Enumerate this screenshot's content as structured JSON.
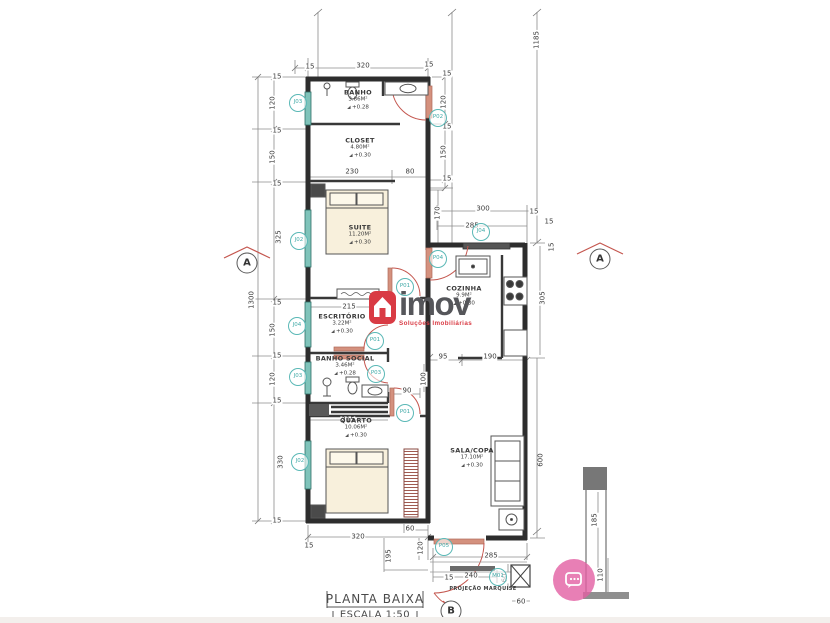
{
  "watermark": {
    "brand": "imov",
    "subtitle": "Soluções Imobiliárias",
    "icon": "house-icon",
    "icon_color": "#d93b44",
    "brand_color": "#55565a"
  },
  "title_block": {
    "line1": "PLANTA BAIXA",
    "line2": "ESCALA 1:50"
  },
  "colors": {
    "tag_teal": "#45b0ae",
    "door_red": "#c4564e",
    "window_teal": "#7fc3ba",
    "chat_pink": "#e25fa3",
    "bed_fill": "#f8f0dc"
  },
  "rooms": [
    {
      "name": "BANHO",
      "area": "3.86M²",
      "level": "+0.28",
      "x": 358,
      "y": 100
    },
    {
      "name": "CLOSET",
      "area": "4.80M²",
      "level": "+0.30",
      "x": 360,
      "y": 148
    },
    {
      "name": "SUITE",
      "area": "11.20M²",
      "level": "+0.30",
      "x": 360,
      "y": 235
    },
    {
      "name": "ESCRITÓRIO",
      "area": "3.22M²",
      "level": "+0.30",
      "x": 342,
      "y": 324
    },
    {
      "name": "BANHO SOCIAL",
      "area": "3.46M²",
      "level": "+0.28",
      "x": 345,
      "y": 366
    },
    {
      "name": "QUARTO",
      "area": "10.06M²",
      "level": "+0.30",
      "x": 356,
      "y": 428
    },
    {
      "name": "COZINHA",
      "area": "9.9M²",
      "level": "+0.30",
      "x": 464,
      "y": 296
    },
    {
      "name": "SALA/COPA",
      "area": "17.10M²",
      "level": "+0.30",
      "x": 472,
      "y": 458
    }
  ],
  "tags": [
    {
      "t": "J03",
      "x": 298,
      "y": 103
    },
    {
      "t": "P02",
      "x": 438,
      "y": 118
    },
    {
      "t": "J02",
      "x": 299,
      "y": 241
    },
    {
      "t": "P04",
      "x": 438,
      "y": 259
    },
    {
      "t": "P01",
      "x": 405,
      "y": 287
    },
    {
      "t": "J04",
      "x": 481,
      "y": 232
    },
    {
      "t": "J04",
      "x": 297,
      "y": 326
    },
    {
      "t": "P01",
      "x": 375,
      "y": 341
    },
    {
      "t": "P03",
      "x": 376,
      "y": 374
    },
    {
      "t": "J03",
      "x": 298,
      "y": 377
    },
    {
      "t": "P01",
      "x": 405,
      "y": 413
    },
    {
      "t": "J02",
      "x": 300,
      "y": 462
    },
    {
      "t": "P05",
      "x": 444,
      "y": 547
    },
    {
      "t": "M01",
      "x": 498,
      "y": 577
    }
  ],
  "dim_labels": [
    {
      "t": "320",
      "x": 363,
      "y": 66
    },
    {
      "t": "15",
      "x": 310,
      "y": 67
    },
    {
      "t": "15",
      "x": 429,
      "y": 65
    },
    {
      "t": "1185",
      "x": 537,
      "y": 40,
      "r": 1
    },
    {
      "t": "15",
      "x": 277,
      "y": 77
    },
    {
      "t": "120",
      "x": 273,
      "y": 103,
      "r": 1
    },
    {
      "t": "15",
      "x": 277,
      "y": 131
    },
    {
      "t": "150",
      "x": 273,
      "y": 157,
      "r": 1
    },
    {
      "t": "15",
      "x": 277,
      "y": 184
    },
    {
      "t": "325",
      "x": 279,
      "y": 237,
      "r": 1
    },
    {
      "t": "1300",
      "x": 252,
      "y": 300,
      "r": 1
    },
    {
      "t": "15",
      "x": 277,
      "y": 303
    },
    {
      "t": "150",
      "x": 273,
      "y": 330,
      "r": 1
    },
    {
      "t": "15",
      "x": 277,
      "y": 356
    },
    {
      "t": "120",
      "x": 273,
      "y": 379,
      "r": 1
    },
    {
      "t": "15",
      "x": 277,
      "y": 401
    },
    {
      "t": "330",
      "x": 281,
      "y": 462,
      "r": 1
    },
    {
      "t": "15",
      "x": 277,
      "y": 521
    },
    {
      "t": "15",
      "x": 447,
      "y": 74
    },
    {
      "t": "120",
      "x": 444,
      "y": 102,
      "r": 1
    },
    {
      "t": "15",
      "x": 447,
      "y": 127
    },
    {
      "t": "150",
      "x": 444,
      "y": 152,
      "r": 1
    },
    {
      "t": "15",
      "x": 447,
      "y": 179
    },
    {
      "t": "170",
      "x": 438,
      "y": 213,
      "r": 1
    },
    {
      "t": "230",
      "x": 352,
      "y": 172
    },
    {
      "t": "80",
      "x": 410,
      "y": 172
    },
    {
      "t": "300",
      "x": 483,
      "y": 209
    },
    {
      "t": "15",
      "x": 534,
      "y": 212
    },
    {
      "t": "285",
      "x": 472,
      "y": 226
    },
    {
      "t": "15",
      "x": 549,
      "y": 222
    },
    {
      "t": "15",
      "x": 552,
      "y": 247,
      "r": 1
    },
    {
      "t": "305",
      "x": 543,
      "y": 298,
      "r": 1
    },
    {
      "t": "215",
      "x": 349,
      "y": 307
    },
    {
      "t": "95",
      "x": 443,
      "y": 357
    },
    {
      "t": "190",
      "x": 490,
      "y": 357
    },
    {
      "t": "100",
      "x": 424,
      "y": 379,
      "r": 1
    },
    {
      "t": "90",
      "x": 407,
      "y": 391
    },
    {
      "t": "215",
      "x": 348,
      "y": 420
    },
    {
      "t": "60",
      "x": 410,
      "y": 529
    },
    {
      "t": "320",
      "x": 358,
      "y": 537
    },
    {
      "t": "15",
      "x": 309,
      "y": 546
    },
    {
      "t": "120",
      "x": 421,
      "y": 548,
      "r": 1
    },
    {
      "t": "195",
      "x": 389,
      "y": 556,
      "r": 1
    },
    {
      "t": "285",
      "x": 491,
      "y": 556
    },
    {
      "t": "240",
      "x": 471,
      "y": 576
    },
    {
      "t": "15",
      "x": 449,
      "y": 578
    },
    {
      "t": "60",
      "x": 505,
      "y": 578,
      "r": 1
    },
    {
      "t": "60",
      "x": 521,
      "y": 602
    },
    {
      "t": "600",
      "x": 541,
      "y": 460,
      "r": 1
    },
    {
      "t": "185",
      "x": 595,
      "y": 520,
      "r": 1
    },
    {
      "t": "110",
      "x": 601,
      "y": 575,
      "r": 1
    }
  ],
  "markers": [
    {
      "label": "A",
      "x": 247,
      "y": 263
    },
    {
      "label": "A",
      "x": 600,
      "y": 259
    },
    {
      "label": "B",
      "x": 451,
      "y": 611
    }
  ],
  "notes": [
    {
      "t": "PROJEÇÃO MARQUISE",
      "x": 483,
      "y": 589
    }
  ]
}
